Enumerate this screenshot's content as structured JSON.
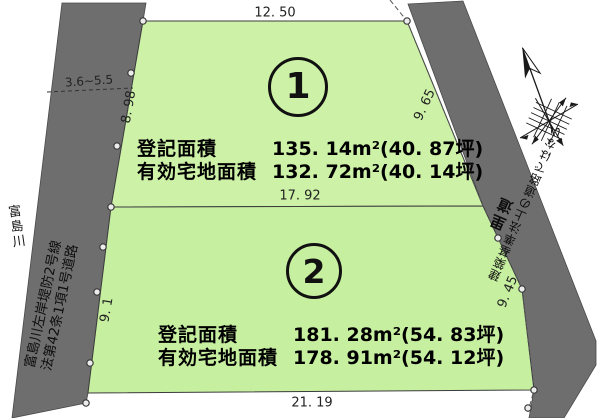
{
  "plot1": {
    "number": "1",
    "registered_label": "登記面積",
    "registered_value": "135. 14m²(40. 87坪)",
    "effective_label": "有効宅地面積",
    "effective_value": "132. 72m²(40. 14坪)"
  },
  "plot2": {
    "number": "2",
    "registered_label": "登記面積",
    "registered_value": "181. 28m²(54. 83坪)",
    "effective_label": "有効宅地面積",
    "effective_value": "178. 91m²(54. 12坪)"
  },
  "dimensions": {
    "top_edge": "12. 50",
    "middle_edge": "17. 92",
    "bottom_edge": "21. 19",
    "left_upper": "8. 98",
    "left_lower": "9. 1",
    "right_upper": "9. 65",
    "right_lower": "9. 45",
    "left_road_width": "3.6~5.5"
  },
  "left_road": {
    "river_name": "富島川",
    "name": "富島川左岸堤防2号線",
    "designation": "法第42条1項1号道路"
  },
  "right_road": {
    "name": "里道",
    "note": "建築基準法上の道路ではない"
  },
  "colors": {
    "plot1_fill": "#cdf2a7",
    "plot2_fill": "#c6efa0",
    "road_fill": "#6e6e6e",
    "outline": "#3c3c3c"
  },
  "icons": {
    "compass": "north-arrow-compass-rose"
  }
}
